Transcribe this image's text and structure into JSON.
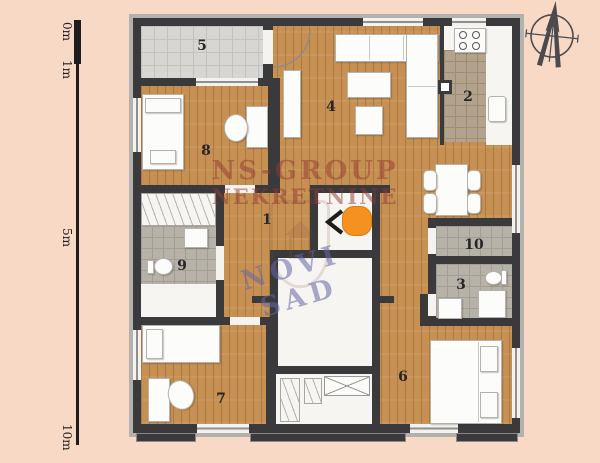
{
  "plan": {
    "scale_labels": [
      "0m",
      "1m",
      "5m",
      "10m"
    ],
    "rooms": [
      {
        "number": "1"
      },
      {
        "number": "2"
      },
      {
        "number": "3"
      },
      {
        "number": "4"
      },
      {
        "number": "5"
      },
      {
        "number": "6"
      },
      {
        "number": "7"
      },
      {
        "number": "8"
      },
      {
        "number": "9"
      },
      {
        "number": "10"
      }
    ],
    "watermark": {
      "line1": "NS-GROUP",
      "line2": "NEKRETNINE",
      "stamp": "NOVI SAD"
    },
    "colors": {
      "background": "#f8d9c6",
      "wall": "#3a3a3c",
      "wall_trim": "#b3b1ae",
      "wood_floor": "#c79053",
      "terrace_tile": "#d7d6d2",
      "bath_tile": "#b7b2a8",
      "kitchen_tile": "#b3a28c",
      "marker_orange": "#f5911e",
      "watermark_red": "#94382f",
      "watermark_blue": "#6464a8"
    }
  }
}
